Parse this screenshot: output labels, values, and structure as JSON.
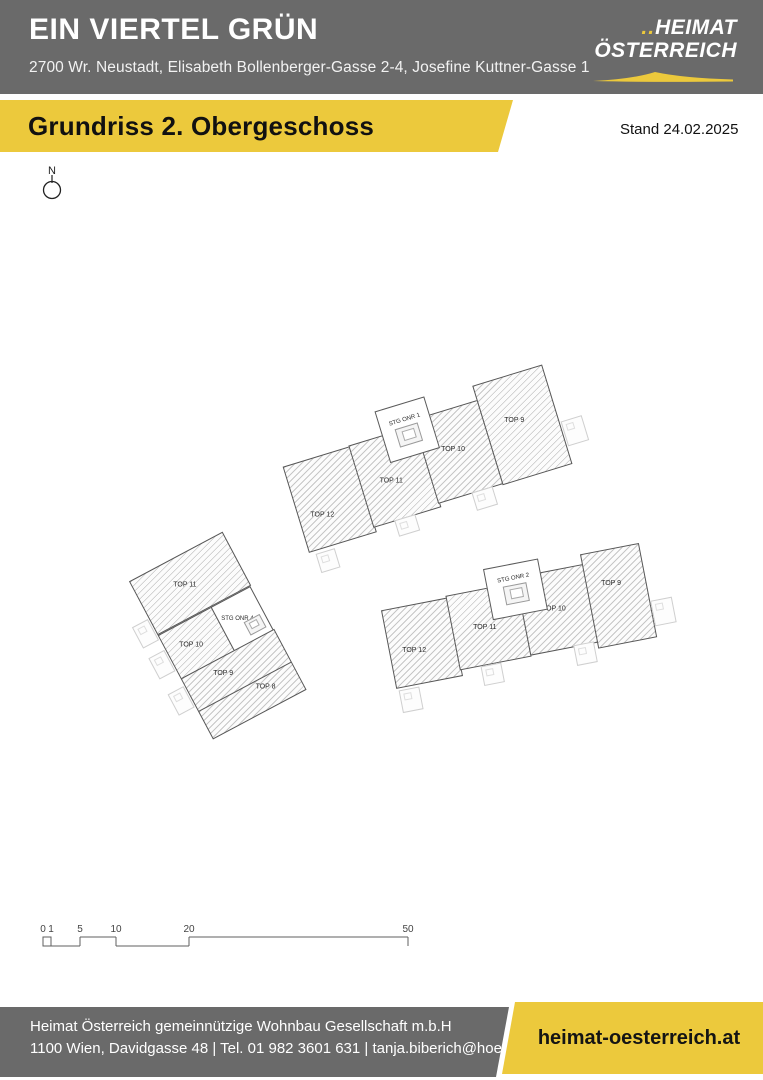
{
  "colors": {
    "header_gray": "#6a6a6a",
    "accent_yellow": "#ecc93c",
    "text_light": "#ffffff",
    "text_dark": "#111111",
    "plan_wall": "#565656",
    "plan_ghost": "#cfcfcf"
  },
  "header": {
    "title": "EIN VIERTEL GRÜN",
    "address": "2700 Wr. Neustadt, Elisabeth Bollenberger-Gasse 2-4, Josefine Kuttner-Gasse 1",
    "logo": {
      "dots": "..",
      "line1": "HEIMAT",
      "line2": "ÖSTERREICH"
    }
  },
  "banner": {
    "title": "Grundriss 2. Obergeschoss",
    "stand": "Stand 24.02.2025"
  },
  "plan": {
    "north_label": "N",
    "buildings": [
      {
        "name": "building-top",
        "stair": "STG ONR 1",
        "units": [
          "TOP 12",
          "TOP 11",
          "TOP 10",
          "TOP 9"
        ]
      },
      {
        "name": "building-left",
        "stair": "STG ONR 4",
        "units": [
          "TOP 11",
          "TOP 10",
          "TOP 9",
          "TOP 8"
        ]
      },
      {
        "name": "building-bottom",
        "stair": "STG ONR 2",
        "units": [
          "TOP 12",
          "TOP 11",
          "TOP 10",
          "TOP 9"
        ]
      }
    ],
    "scale_bar": {
      "unit": "m",
      "labels": [
        "0",
        "1",
        "5",
        "10",
        "20",
        "50"
      ]
    }
  },
  "footer": {
    "company": "Heimat Österreich gemeinnützige Wohnbau Gesellschaft m.b.H",
    "contact": "1100 Wien, Davidgasse 48 | Tel. 01 982 3601 631 | tanja.biberich@hoe.at",
    "website": "heimat-oesterreich.at"
  }
}
